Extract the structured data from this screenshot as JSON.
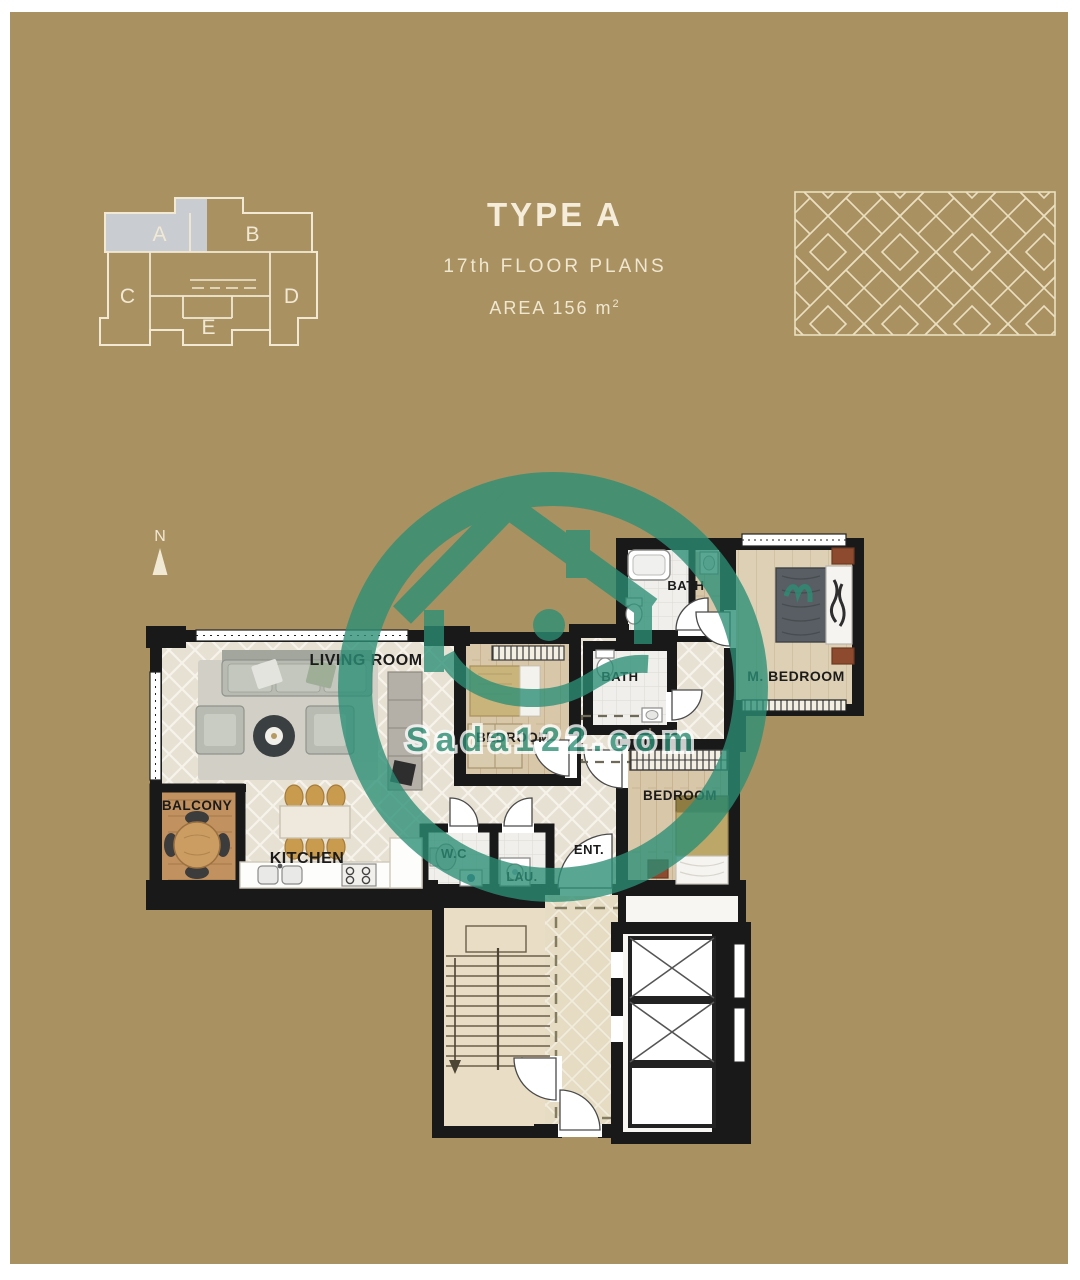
{
  "canvas": {
    "background_color": "#a99161",
    "frame_color": "#ffffff",
    "line_cream": "#f2e9d4",
    "wall_color": "#191919",
    "watermark_green": "#2b8f76",
    "keyplan_highlight": "#c9ccd1"
  },
  "title_block": {
    "type_label": "TYPE A",
    "floor_label": "17th FLOOR PLANS",
    "area_label": "AREA  156 m",
    "area_sup": "2"
  },
  "key_plan": {
    "units": [
      {
        "label": "A",
        "highlighted": true
      },
      {
        "label": "B",
        "highlighted": false
      },
      {
        "label": "C",
        "highlighted": false
      },
      {
        "label": "D",
        "highlighted": false
      },
      {
        "label": "E",
        "highlighted": false
      }
    ]
  },
  "compass": {
    "label": "N"
  },
  "watermark": {
    "site": "Sada122.com"
  },
  "floor_plan": {
    "labels": {
      "living_room": "LIVING ROOM",
      "balcony": "BALCONY",
      "kitchen": "KITCHEN",
      "bedroom_center": "BEDROOM",
      "bath_inner": "BATH",
      "bath_upper": "BATH",
      "master_bedroom": "M. BEDROOM",
      "bedroom_right": "BEDROOM",
      "wc": "W.C",
      "laundry": "LAU.",
      "entrance": "ENT."
    }
  }
}
